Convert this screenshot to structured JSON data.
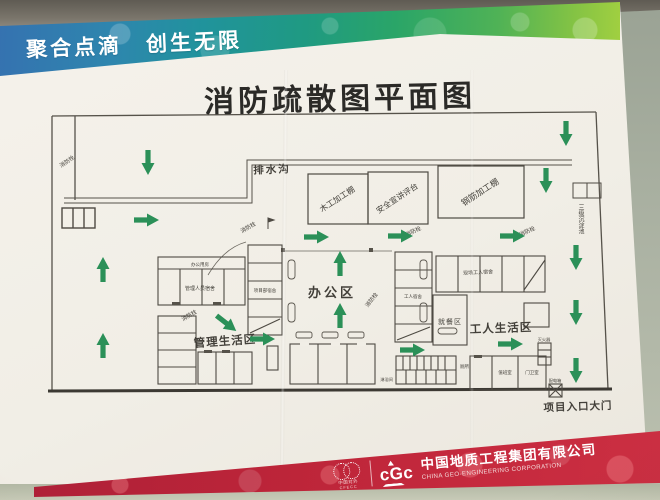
{
  "poster": {
    "slogan": "聚合点滴　创生无限",
    "title": "消防疏散图平面图",
    "footer": {
      "company_cn": "中国地质工程集团有限公司",
      "company_en": "CHINA GEO-ENGINEERING CORPORATION",
      "logo_text": "cGc",
      "left_logo_line1": "中国对外",
      "left_logo_line2": "CFECC"
    }
  },
  "plan": {
    "labels": {
      "drain": "排水沟",
      "wood_shed": "木工加工棚",
      "safety_stage": "安全宣讲评台",
      "rebar_shed": "钢筋加工棚",
      "office_area": "办公区",
      "mgmt_area": "管理生活区",
      "worker_area": "工人生活区",
      "dining": "就餐区",
      "gate": "项目入口大门",
      "sediment": "三级沉淀池",
      "hydrant": "消防栓",
      "extinguisher": "灭火器",
      "power_box": "配电箱",
      "mgmt_band": "办公用房",
      "mgmt_dorm": "管理人员宿舍",
      "proj_dorm": "项目部宿舍",
      "worker_dorm": "工人宿舍",
      "site_worker_dorm": "现场工人宿舍",
      "toilet": "厕所",
      "shower": "淋浴间",
      "duty_room": "值班室",
      "guard_room": "门卫室"
    },
    "arrow_color": "#2b9058",
    "arrows": [
      {
        "x": 148,
        "y": 162,
        "r": 90
      },
      {
        "x": 146,
        "y": 220,
        "r": 0
      },
      {
        "x": 103,
        "y": 270,
        "r": -90
      },
      {
        "x": 103,
        "y": 346,
        "r": -90
      },
      {
        "x": 566,
        "y": 133,
        "r": 90
      },
      {
        "x": 546,
        "y": 180,
        "r": 90
      },
      {
        "x": 316,
        "y": 237,
        "r": 0
      },
      {
        "x": 400,
        "y": 236,
        "r": 0
      },
      {
        "x": 512,
        "y": 236,
        "r": 0
      },
      {
        "x": 340,
        "y": 264,
        "r": -90
      },
      {
        "x": 340,
        "y": 316,
        "r": -90
      },
      {
        "x": 226,
        "y": 323,
        "r": 38
      },
      {
        "x": 262,
        "y": 339,
        "r": 0
      },
      {
        "x": 412,
        "y": 350,
        "r": 0
      },
      {
        "x": 510,
        "y": 344,
        "r": 0
      },
      {
        "x": 576,
        "y": 257,
        "r": 90
      },
      {
        "x": 576,
        "y": 312,
        "r": 90
      },
      {
        "x": 576,
        "y": 370,
        "r": 90
      }
    ],
    "hydrants": [
      {
        "x": 68,
        "y": 163,
        "r": -35
      },
      {
        "x": 249,
        "y": 229,
        "r": -30
      },
      {
        "x": 414,
        "y": 233,
        "r": -25
      },
      {
        "x": 373,
        "y": 301,
        "r": -52
      },
      {
        "x": 190,
        "y": 317,
        "r": -30
      },
      {
        "x": 528,
        "y": 233,
        "r": -25
      }
    ]
  }
}
